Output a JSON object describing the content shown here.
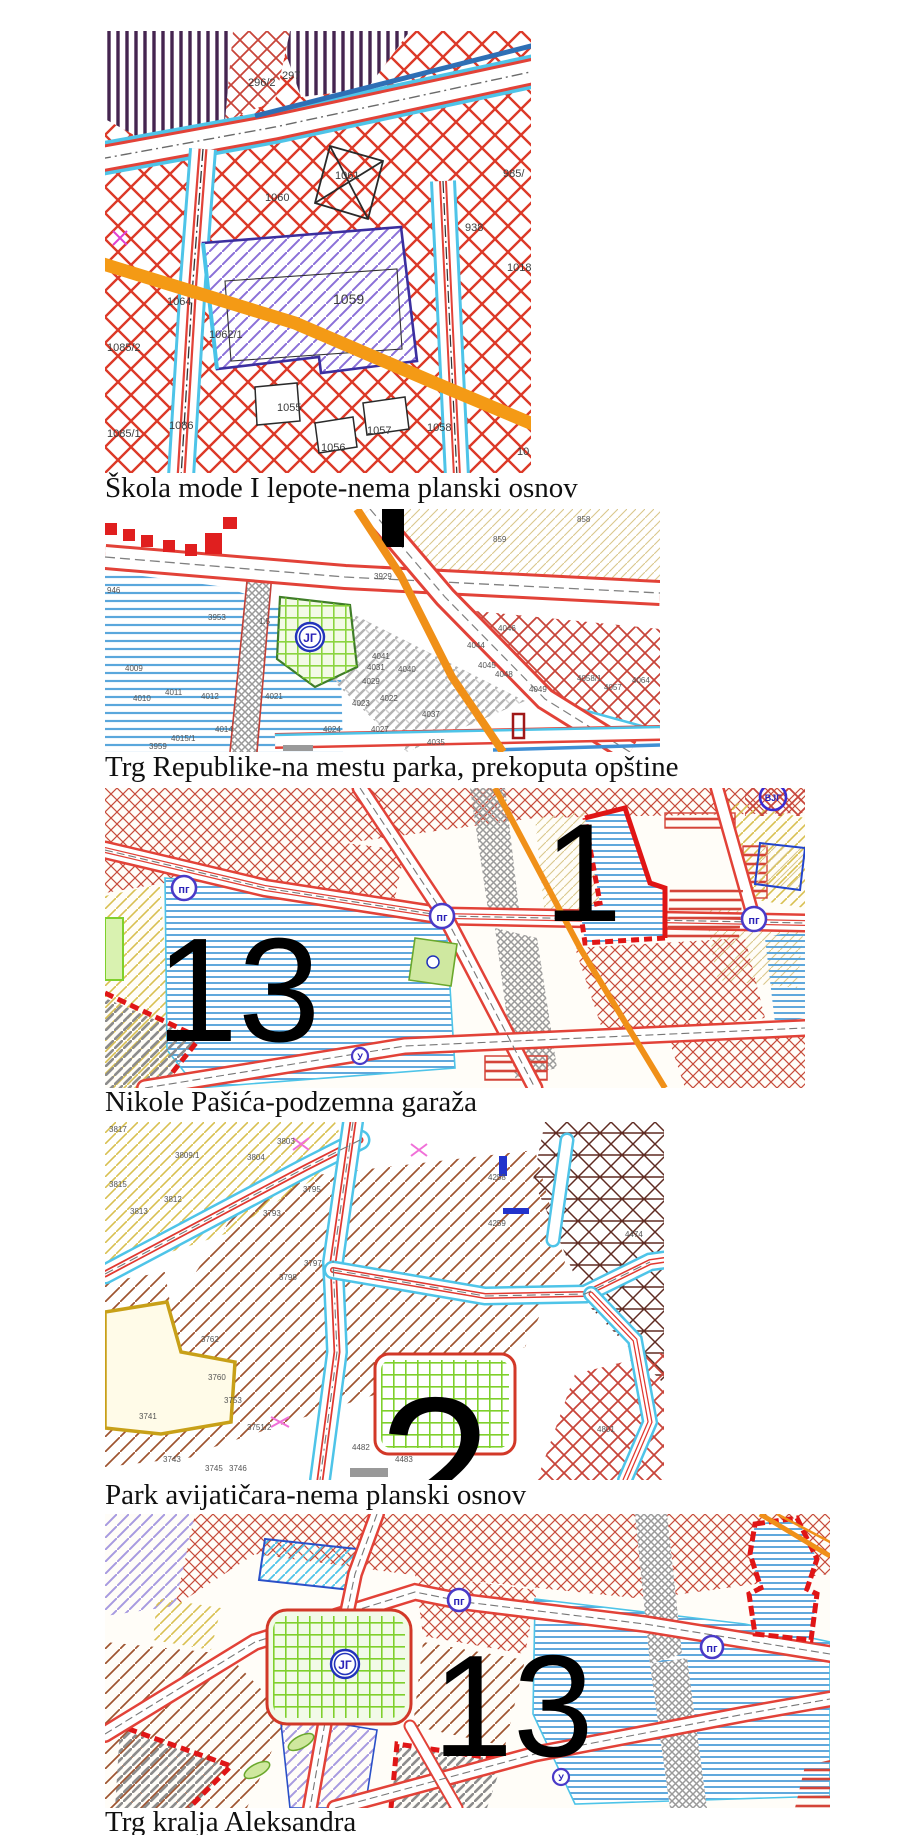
{
  "captions": {
    "c1": "Škola mode I lepote-nema planski osnov",
    "c2": "Trg Republike-na mestu parka, prekoputa opštine",
    "c3": "Nikole Pašića-podzemna garaža",
    "c4": "Park avijatičara-nema planski osnov",
    "c5": "Trg kralja Aleksandra"
  },
  "colors": {
    "hatch_red": "#dc3928",
    "road_red": "#e24238",
    "road_cyan": "#4ec4e8",
    "orange_band": "#f49a15",
    "purple_hatch": "#8a70d8",
    "blue_stripe": "#57a8dc",
    "park_green": "#7fd02c",
    "marker_blue": "#3a2ad0",
    "numeral_black": "#000000"
  },
  "maps": {
    "m1": {
      "parcels": [
        "296/2",
        "297",
        "1061",
        "1060",
        "985/",
        "938",
        "1018",
        "1064",
        "1059",
        "1062/1",
        "1085/2",
        "1055",
        "1086",
        "1085/1",
        "1056",
        "1057",
        "1058",
        "10"
      ]
    },
    "m2": {
      "circle_label": "ЈГ",
      "labels": [
        "946",
        "3953",
        "4009",
        "4010",
        "4011",
        "4012",
        "4014",
        "4015/1",
        "3959",
        "4021",
        "4024",
        "4027",
        "4023",
        "4022",
        "4029",
        "4031",
        "4041",
        "4040",
        "4037",
        "4035",
        "3929",
        "858",
        "859",
        "1.5",
        "4044",
        "4045",
        "4046",
        "4048",
        "4049",
        "4058/1",
        "4057",
        "4064"
      ]
    },
    "m3": {
      "big_left": "13",
      "big_right": "1",
      "pg": "пг",
      "vjg": "ВЈГ",
      "u": "У"
    },
    "m4": {
      "big": "2",
      "labels": [
        "3817",
        "3803",
        "3809/1",
        "3804",
        "3815",
        "3812",
        "3813",
        "3793",
        "3795",
        "3797",
        "3798",
        "4258",
        "4259",
        "4474",
        "4478",
        "3741",
        "3762",
        "3753",
        "3751/2",
        "3760",
        "3743",
        "3745",
        "3746",
        "4482",
        "4483",
        "4801"
      ]
    },
    "m5": {
      "big": "13",
      "jg": "ЈГ",
      "pg": "пг",
      "u": "У"
    }
  }
}
